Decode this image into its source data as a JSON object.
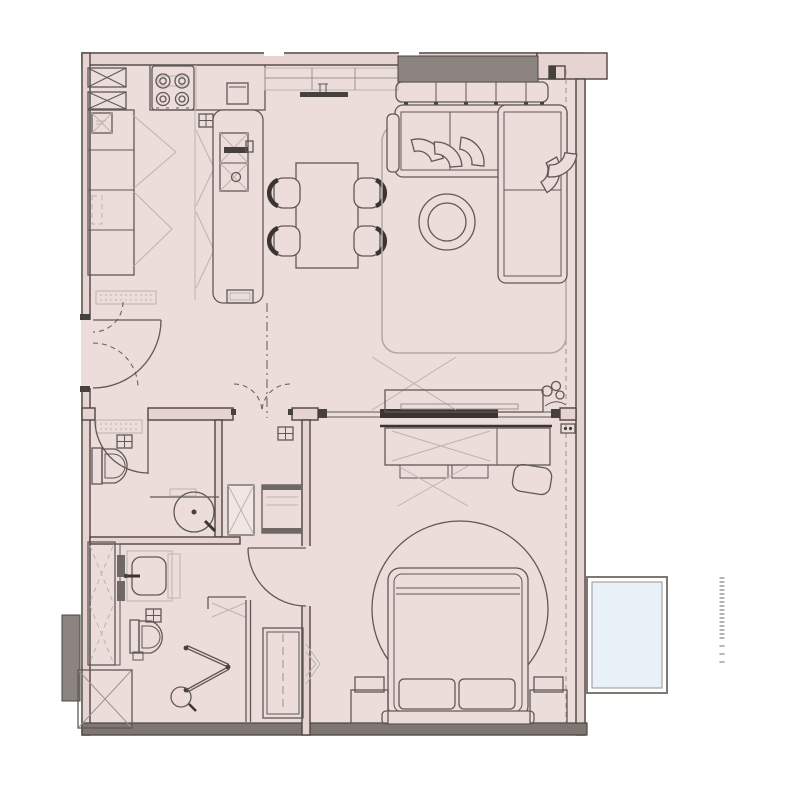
{
  "meta": {
    "title": "One-bedroom apartment floor plan with curved balcony",
    "drawing_type": "architectural floor plan, top view, no text labels"
  },
  "palette": {
    "background": "#ffffff",
    "floor": "#ecdcda",
    "floor_light": "#f1e6e4",
    "wall_fill": "#e7d4d1",
    "wall_line": "#4b4541",
    "furniture_line": "#5f5955",
    "light_line": "#bcb4b0",
    "mid_line": "#9a948f",
    "rug_line": "#b1a9a5",
    "dark_element": "#8b8480",
    "panel_dark": "#3a3531",
    "hardware_dark": "#46413d",
    "slat_dark": "#6f6965",
    "bottom_wall": "#7d7672",
    "glass_fill": "#e9f1f8",
    "glass_border": "#7e7873"
  },
  "rooms": {
    "kitchen": "Kitchen with island and tall cabinet run",
    "dining": "Dining area with table and four chairs",
    "living": "Living room with corner sofa and TV wall",
    "entry": "Entry hall with swing door",
    "guest_bathroom": "Guest bathroom with toilet and round basin",
    "hallway": "Inner hallway with double doors, shaft and closet",
    "master_bathroom": "Master bathroom with basin, toilet and shower",
    "bedroom": "Bedroom with double bed, wardrobe and dresser",
    "balcony": "Wrap-around balcony with rounded corners and glazed panel"
  },
  "furniture": {
    "kitchen": [
      "cooktop-4-burners",
      "tall-cabinet-column",
      "island-with-double-sink",
      "wall-cabinets",
      "appliance-boxes"
    ],
    "dining": [
      "rectangular-table",
      "chair",
      "chair",
      "chair",
      "chair"
    ],
    "living": [
      "corner-sofa",
      "seat-cushions",
      "round-coffee-table",
      "area-rug",
      "tv-console",
      "media-bench",
      "sideboard",
      "plant"
    ],
    "bedroom": [
      "double-bed",
      "pillows",
      "headboard",
      "nightstand-left",
      "nightstand-right",
      "round-rug",
      "dresser",
      "pouf",
      "tall-wardrobe"
    ],
    "guest_bathroom": [
      "toilet",
      "round-washbasin",
      "vanity-counter"
    ],
    "master_bathroom": [
      "washbasin-cabinet",
      "toilet",
      "folding-shower-door",
      "shower-stool",
      "linen-cabinet"
    ],
    "balcony": [
      "glazed-floor-panel",
      "railing-hatch"
    ]
  },
  "counts": {
    "bedrooms": 1,
    "bathrooms": 2,
    "balconies": 1
  }
}
